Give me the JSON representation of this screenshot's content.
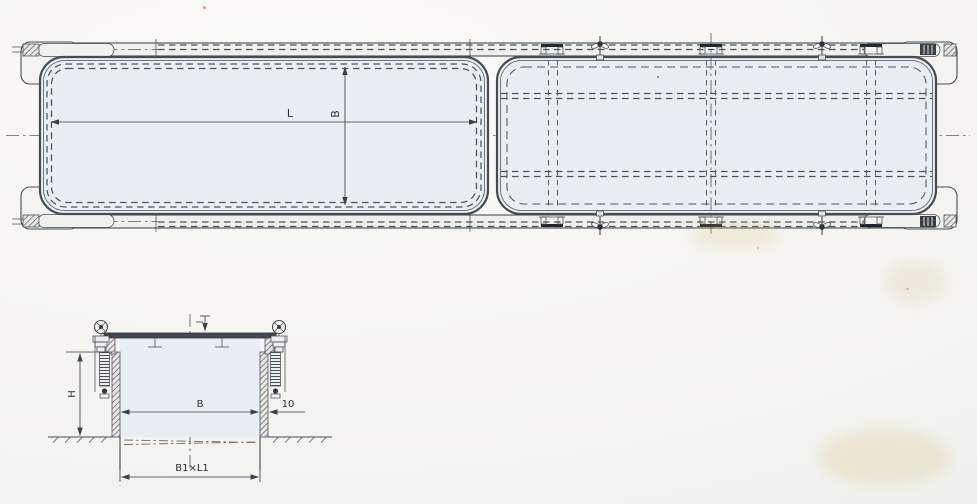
{
  "drawing": {
    "plan_view": {
      "length_label": "L",
      "width_label": "B"
    },
    "section_view": {
      "height_label": "H",
      "clear_width_label": "B",
      "wall_thickness_label": "10",
      "opening_size_label": "B1×L1"
    },
    "colors": {
      "panel_fill": "#e9eef5",
      "rail_fill": "#f0f0ec",
      "bracket_fill": "#f4f3ef",
      "steel_dark": "#454a50"
    }
  }
}
